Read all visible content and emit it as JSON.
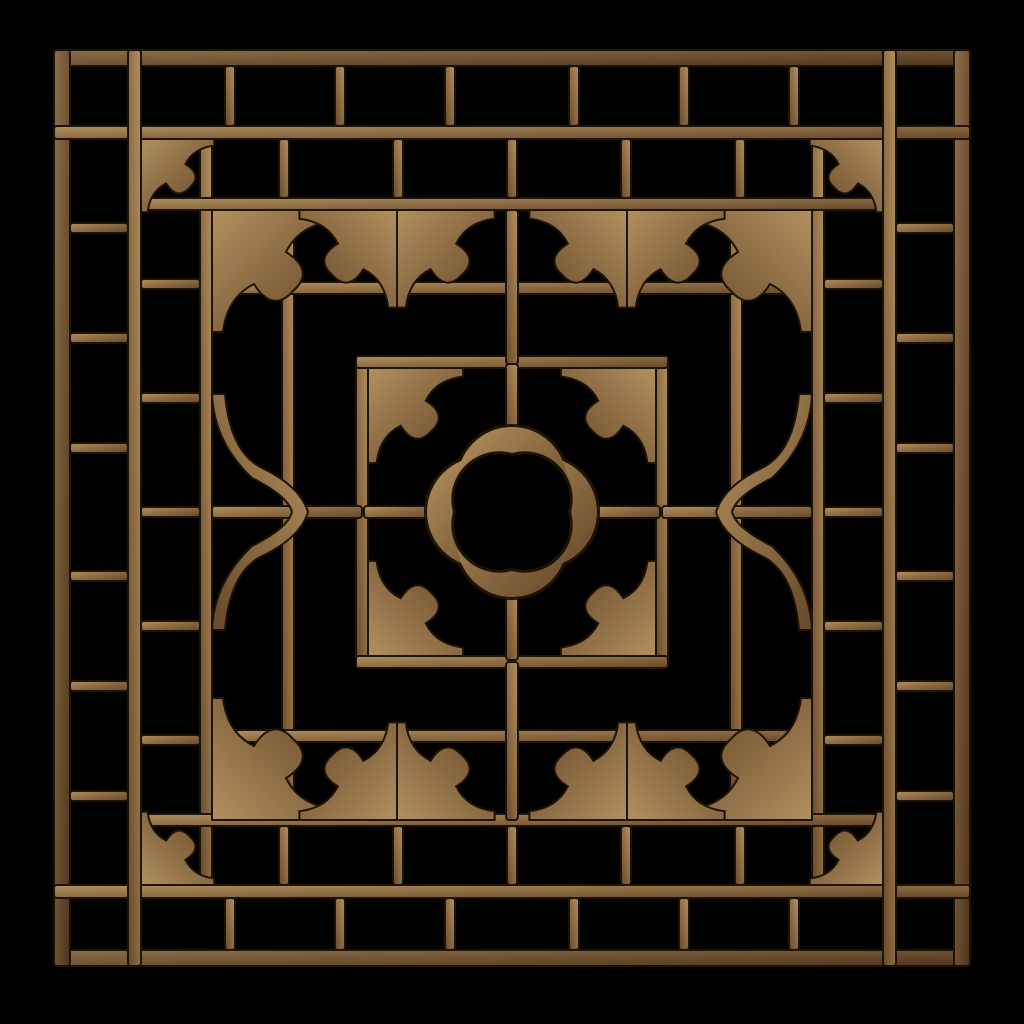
{
  "scene": {
    "description": "Photograph of an antique Chinese carved wooden lattice window panel (fretwork screen) with geometric grid cells, ruyi cloud corner brackets and a central quatrefoil medallion, isolated on a black background",
    "object": "chinese-wooden-lattice-window-panel",
    "background_color": "#000000"
  },
  "colors": {
    "background": "#000000",
    "outline": "#1f1305",
    "wood_light": "#b2905f",
    "wood_mid": "#8a6a42",
    "wood_dark": "#66492a",
    "frame_light": "#8f6f4a",
    "frame_mid": "#6e5233",
    "frame_dark": "#4e351c"
  },
  "geometry": {
    "canvas": 1024,
    "bar_corner_radius": 3,
    "bar_stroke_width": 2,
    "bracket_path": "M0,122 L0,0 L122,0 L122,11 C96,14 82,26 74,42 C95,55 95,69 81,81 C69,95 55,95 42,74 C26,82 14,96 11,122 Z",
    "arch_path": "M0,-118 L13,-118 Q18,-60 50,-44 Q88,-26 96,0 Q88,26 50,44 Q18,60 13,118 L0,118 Q2,70 40,34 Q76,16 80,0 Q76,-16 40,-34 Q2,-70 0,-118 Z",
    "bars": [
      {
        "x": 54,
        "y": 50,
        "w": 916,
        "h": 16,
        "k": "f"
      },
      {
        "x": 54,
        "y": 950,
        "w": 916,
        "h": 16,
        "k": "f"
      },
      {
        "x": 54,
        "y": 50,
        "w": 16,
        "h": 916,
        "k": "f"
      },
      {
        "x": 954,
        "y": 50,
        "w": 16,
        "h": 916,
        "k": "f"
      },
      {
        "x": 54,
        "y": 126,
        "w": 916,
        "h": 13
      },
      {
        "x": 54,
        "y": 885,
        "w": 916,
        "h": 13
      },
      {
        "x": 128,
        "y": 50,
        "w": 13,
        "h": 916
      },
      {
        "x": 883,
        "y": 50,
        "w": 13,
        "h": 916
      },
      {
        "x": 225,
        "y": 66,
        "w": 10,
        "h": 60
      },
      {
        "x": 335,
        "y": 66,
        "w": 10,
        "h": 60
      },
      {
        "x": 445,
        "y": 66,
        "w": 10,
        "h": 60
      },
      {
        "x": 569,
        "y": 66,
        "w": 10,
        "h": 60
      },
      {
        "x": 679,
        "y": 66,
        "w": 10,
        "h": 60
      },
      {
        "x": 789,
        "y": 66,
        "w": 10,
        "h": 60
      },
      {
        "x": 225,
        "y": 898,
        "w": 10,
        "h": 52
      },
      {
        "x": 335,
        "y": 898,
        "w": 10,
        "h": 52
      },
      {
        "x": 445,
        "y": 898,
        "w": 10,
        "h": 52
      },
      {
        "x": 569,
        "y": 898,
        "w": 10,
        "h": 52
      },
      {
        "x": 679,
        "y": 898,
        "w": 10,
        "h": 52
      },
      {
        "x": 789,
        "y": 898,
        "w": 10,
        "h": 52
      },
      {
        "x": 70,
        "y": 223,
        "w": 58,
        "h": 10
      },
      {
        "x": 70,
        "y": 333,
        "w": 58,
        "h": 10
      },
      {
        "x": 70,
        "y": 443,
        "w": 58,
        "h": 10
      },
      {
        "x": 70,
        "y": 571,
        "w": 58,
        "h": 10
      },
      {
        "x": 70,
        "y": 681,
        "w": 58,
        "h": 10
      },
      {
        "x": 70,
        "y": 791,
        "w": 58,
        "h": 10
      },
      {
        "x": 896,
        "y": 223,
        "w": 58,
        "h": 10
      },
      {
        "x": 896,
        "y": 333,
        "w": 58,
        "h": 10
      },
      {
        "x": 896,
        "y": 443,
        "w": 58,
        "h": 10
      },
      {
        "x": 896,
        "y": 571,
        "w": 58,
        "h": 10
      },
      {
        "x": 896,
        "y": 681,
        "w": 58,
        "h": 10
      },
      {
        "x": 896,
        "y": 791,
        "w": 58,
        "h": 10
      },
      {
        "x": 200,
        "y": 139,
        "w": 12,
        "h": 746
      },
      {
        "x": 812,
        "y": 139,
        "w": 12,
        "h": 746
      },
      {
        "x": 141,
        "y": 198,
        "w": 742,
        "h": 12
      },
      {
        "x": 141,
        "y": 814,
        "w": 742,
        "h": 12
      },
      {
        "x": 279,
        "y": 139,
        "w": 10,
        "h": 59
      },
      {
        "x": 393,
        "y": 139,
        "w": 10,
        "h": 59
      },
      {
        "x": 507,
        "y": 139,
        "w": 10,
        "h": 59
      },
      {
        "x": 621,
        "y": 139,
        "w": 10,
        "h": 59
      },
      {
        "x": 735,
        "y": 139,
        "w": 10,
        "h": 59
      },
      {
        "x": 279,
        "y": 826,
        "w": 10,
        "h": 59
      },
      {
        "x": 393,
        "y": 826,
        "w": 10,
        "h": 59
      },
      {
        "x": 507,
        "y": 826,
        "w": 10,
        "h": 59
      },
      {
        "x": 621,
        "y": 826,
        "w": 10,
        "h": 59
      },
      {
        "x": 735,
        "y": 826,
        "w": 10,
        "h": 59
      },
      {
        "x": 141,
        "y": 279,
        "w": 59,
        "h": 10
      },
      {
        "x": 141,
        "y": 393,
        "w": 59,
        "h": 10
      },
      {
        "x": 141,
        "y": 507,
        "w": 59,
        "h": 10
      },
      {
        "x": 141,
        "y": 621,
        "w": 59,
        "h": 10
      },
      {
        "x": 141,
        "y": 735,
        "w": 59,
        "h": 10
      },
      {
        "x": 824,
        "y": 279,
        "w": 59,
        "h": 10
      },
      {
        "x": 824,
        "y": 393,
        "w": 59,
        "h": 10
      },
      {
        "x": 824,
        "y": 507,
        "w": 59,
        "h": 10
      },
      {
        "x": 824,
        "y": 621,
        "w": 59,
        "h": 10
      },
      {
        "x": 824,
        "y": 735,
        "w": 59,
        "h": 10
      },
      {
        "x": 282,
        "y": 210,
        "w": 12,
        "h": 604
      },
      {
        "x": 730,
        "y": 210,
        "w": 12,
        "h": 604
      },
      {
        "x": 212,
        "y": 282,
        "w": 600,
        "h": 12
      },
      {
        "x": 212,
        "y": 730,
        "w": 600,
        "h": 12
      },
      {
        "x": 356,
        "y": 356,
        "w": 12,
        "h": 312
      },
      {
        "x": 656,
        "y": 356,
        "w": 12,
        "h": 312
      },
      {
        "x": 356,
        "y": 356,
        "w": 312,
        "h": 12
      },
      {
        "x": 356,
        "y": 656,
        "w": 312,
        "h": 12
      },
      {
        "x": 506,
        "y": 210,
        "w": 12,
        "h": 154
      },
      {
        "x": 506,
        "y": 662,
        "w": 12,
        "h": 158
      },
      {
        "x": 212,
        "y": 506,
        "w": 150,
        "h": 12
      },
      {
        "x": 662,
        "y": 506,
        "w": 150,
        "h": 12
      },
      {
        "x": 506,
        "y": 364,
        "w": 12,
        "h": 70
      },
      {
        "x": 506,
        "y": 590,
        "w": 12,
        "h": 70
      },
      {
        "x": 364,
        "y": 506,
        "w": 70,
        "h": 12
      },
      {
        "x": 590,
        "y": 506,
        "w": 70,
        "h": 12
      }
    ],
    "brackets": [
      {
        "x": 141,
        "y": 139,
        "sx": 0.6,
        "sy": 0.6
      },
      {
        "x": 883,
        "y": 139,
        "sx": -0.6,
        "sy": 0.6
      },
      {
        "x": 883,
        "y": 885,
        "sx": -0.6,
        "sy": -0.6
      },
      {
        "x": 141,
        "y": 885,
        "sx": 0.6,
        "sy": -0.6
      },
      {
        "x": 212,
        "y": 210,
        "sx": 1,
        "sy": 1
      },
      {
        "x": 812,
        "y": 210,
        "sx": -1,
        "sy": 1
      },
      {
        "x": 812,
        "y": 820,
        "sx": -1,
        "sy": -1
      },
      {
        "x": 212,
        "y": 820,
        "sx": 1,
        "sy": -1
      },
      {
        "x": 368,
        "y": 368,
        "sx": 0.78,
        "sy": 0.78
      },
      {
        "x": 656,
        "y": 368,
        "sx": -0.78,
        "sy": 0.78
      },
      {
        "x": 656,
        "y": 656,
        "sx": -0.78,
        "sy": -0.78
      },
      {
        "x": 368,
        "y": 656,
        "sx": 0.78,
        "sy": -0.78
      },
      {
        "x": 397,
        "y": 210,
        "sx": -0.8,
        "sy": 0.8
      },
      {
        "x": 397,
        "y": 210,
        "sx": 0.8,
        "sy": 0.8
      },
      {
        "x": 627,
        "y": 210,
        "sx": -0.8,
        "sy": 0.8
      },
      {
        "x": 627,
        "y": 210,
        "sx": 0.8,
        "sy": 0.8
      },
      {
        "x": 397,
        "y": 820,
        "sx": -0.8,
        "sy": -0.8
      },
      {
        "x": 397,
        "y": 820,
        "sx": 0.8,
        "sy": -0.8
      },
      {
        "x": 627,
        "y": 820,
        "sx": -0.8,
        "sy": -0.8
      },
      {
        "x": 627,
        "y": 820,
        "sx": 0.8,
        "sy": -0.8
      }
    ],
    "arches": [
      {
        "x": 212,
        "y": 512,
        "sx": 1,
        "sy": 1
      },
      {
        "x": 812,
        "y": 512,
        "sx": -1,
        "sy": 1
      }
    ],
    "quatrefoil": {
      "cx": 512,
      "cy": 512,
      "lobe_offset": 30,
      "lobe_r": 55,
      "lobe_rim_r": 58,
      "hole_diag_offset": 12.7,
      "hole_r": 45,
      "hole_rim_r": 48
    }
  }
}
